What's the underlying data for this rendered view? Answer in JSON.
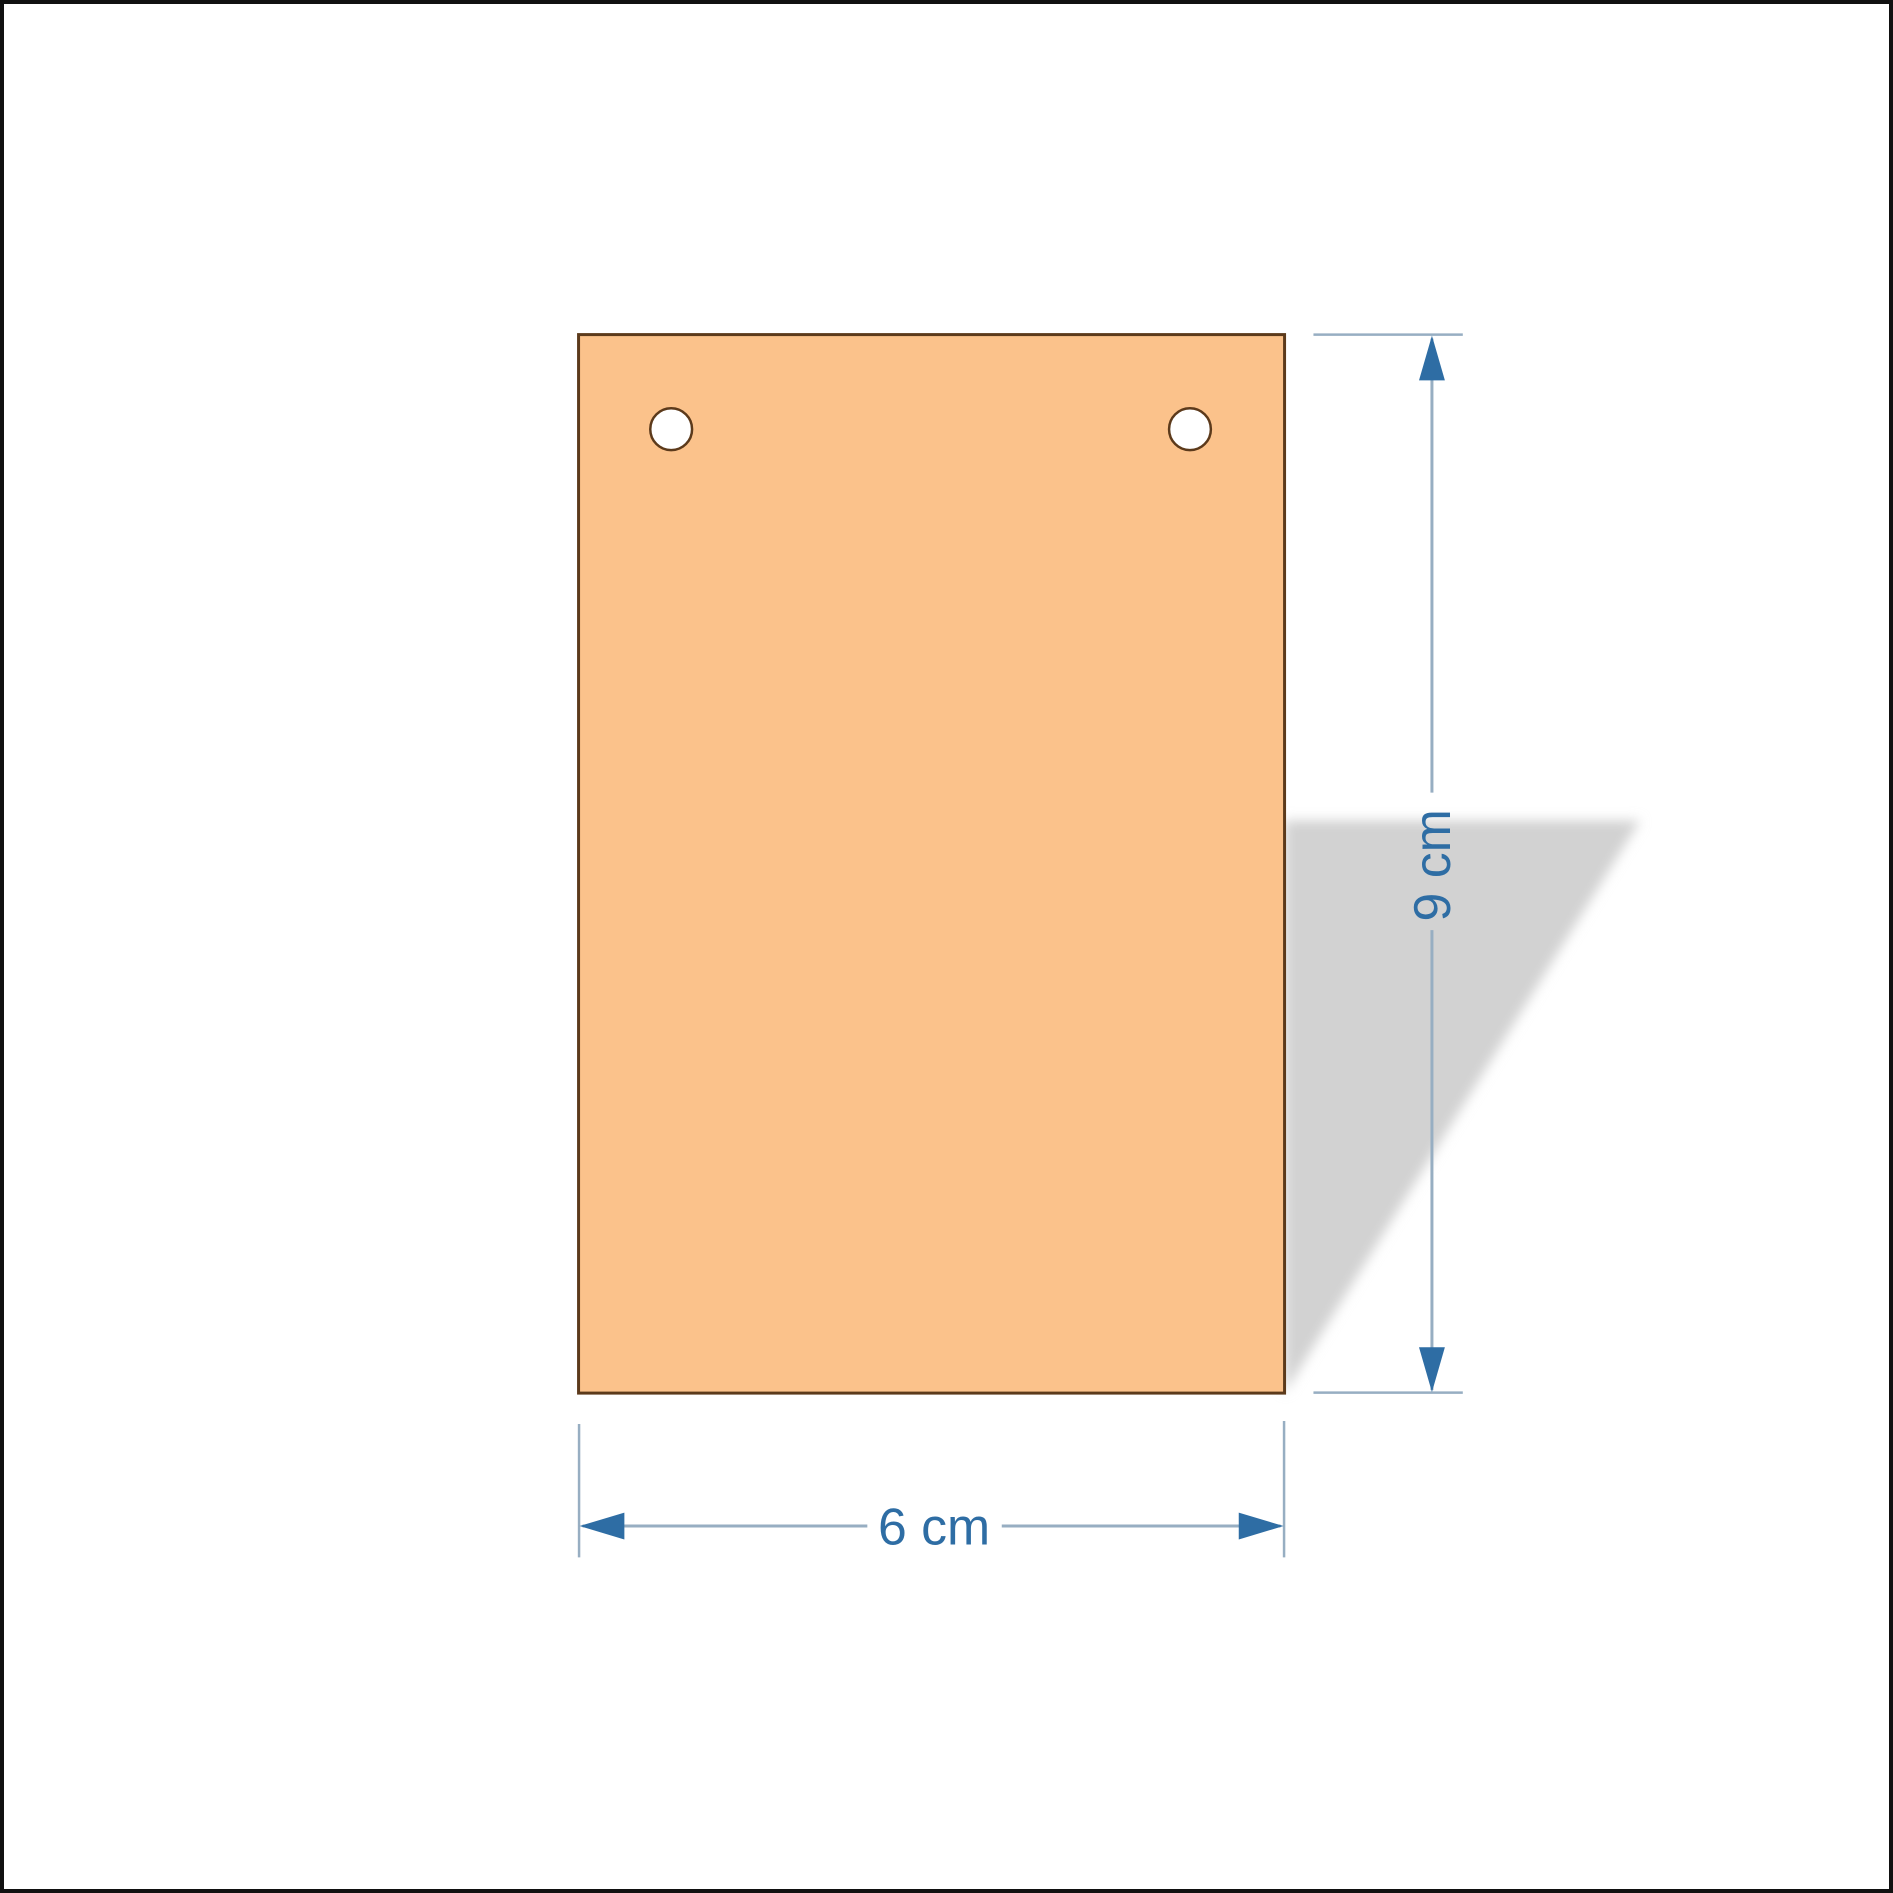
{
  "diagram": {
    "description": "Plywood plaque blank with two hanging holes and dimension annotations",
    "dimensions": {
      "height_label": "9 cm",
      "width_label": "6 cm"
    }
  },
  "colors": {
    "background": "#ffffff",
    "canvas_border": "#111111",
    "plaque_fill": "#fbc28b",
    "plaque_outline": "#5c3a1b",
    "hole_fill": "#ffffff",
    "shadow": "#d2d2d2",
    "dimension_line": "#97aec2",
    "dimension_accent": "#2e6da4"
  }
}
